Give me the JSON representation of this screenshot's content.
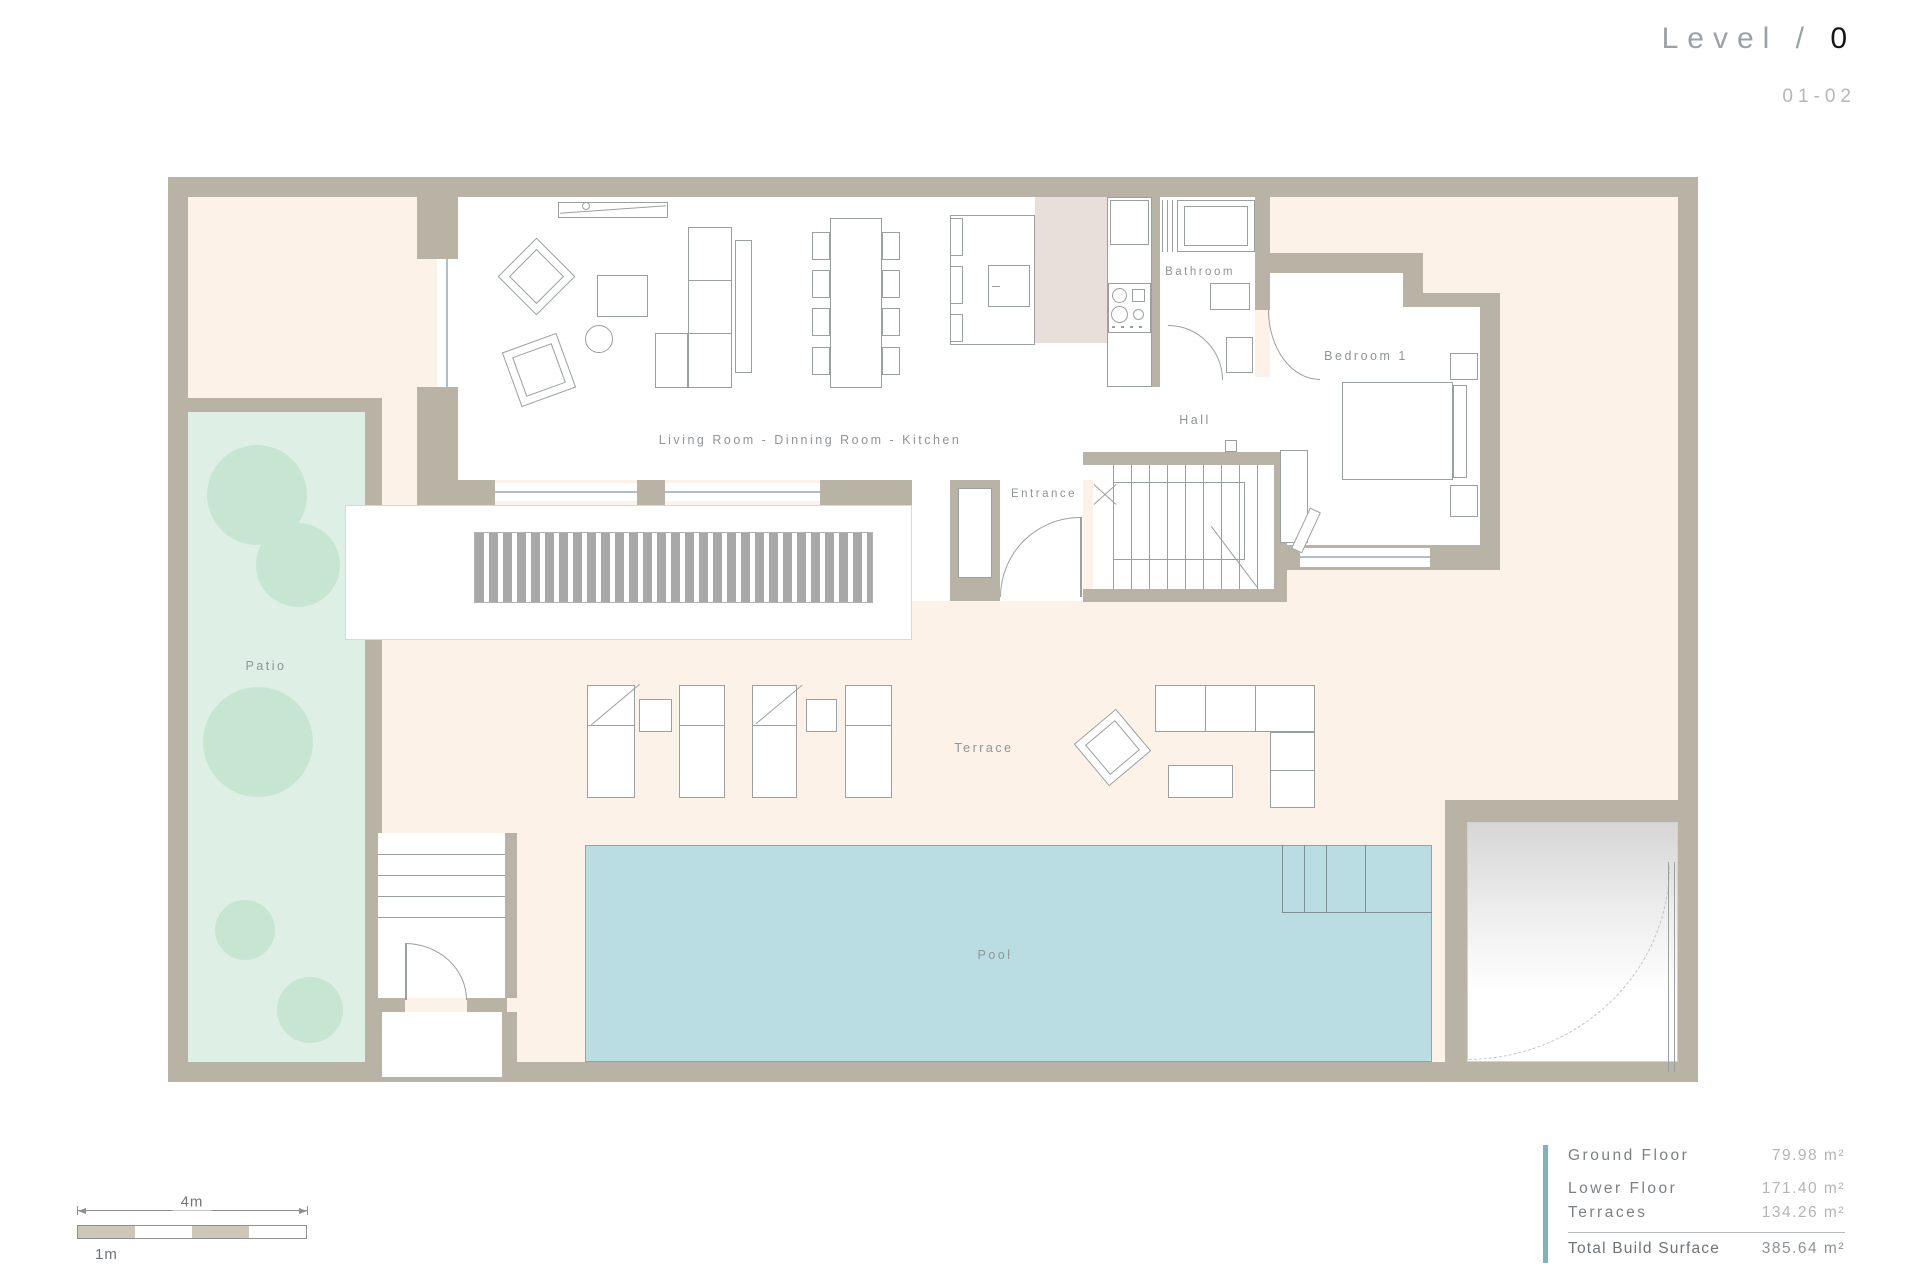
{
  "header": {
    "title_prefix": "Level /",
    "title_number": "0",
    "sheet_number": "01-02"
  },
  "rooms": {
    "living": "Living Room - Dinning Room - Kitchen",
    "bathroom": "Bathroom",
    "bedroom1": "Bedroom 1",
    "hall": "Hall",
    "entrance": "Entrance",
    "patio": "Patio",
    "terrace": "Terrace",
    "pool": "Pool"
  },
  "scale_bar": {
    "total_label": "4m",
    "unit_label": "1m"
  },
  "area_table": {
    "rows": [
      {
        "label": "Ground Floor",
        "value": "79.98 m²"
      },
      {
        "label": "Lower Floor",
        "value": "171.40 m²"
      },
      {
        "label": "Terraces",
        "value": "134.26 m²"
      }
    ],
    "total": {
      "label": "Total Build Surface",
      "value": "385.64 m²"
    }
  },
  "palette": {
    "wall": "#b9b3a5",
    "site_background": "#fcf2e8",
    "patio_green": "#def0e5",
    "tree_green": "#c7e6d1",
    "pool_blue": "#b9dde2",
    "kitchen_block": "#e9dfda",
    "accent_bar": "#7fb2bf",
    "title_number": "#161616"
  }
}
